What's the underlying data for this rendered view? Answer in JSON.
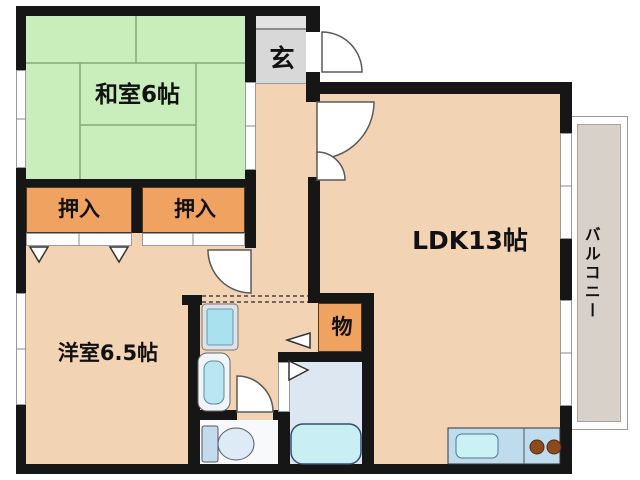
{
  "rooms": {
    "washitsu": {
      "label": "和室6帖"
    },
    "genkan": {
      "label": "玄"
    },
    "ldk": {
      "label": "LDK13帖"
    },
    "closet_left": {
      "label": "押入"
    },
    "closet_right": {
      "label": "押入"
    },
    "youshitsu": {
      "label": "洋室6.5帖"
    },
    "storage": {
      "label": "物"
    },
    "balcony": {
      "label": "バルコニー"
    }
  },
  "fixtures": {
    "washing_machine": "washing-machine-pan",
    "washbasin": "washbasin",
    "toilet": "toilet",
    "bathtub": "bathtub",
    "kitchen_sink": "kitchen-sink",
    "stove": "two-burner-stove"
  },
  "palette": {
    "wall": "#161616",
    "room_peach": "#f2d4b5",
    "tatami_green": "#c9eebb",
    "tatami_line": "#86aa74",
    "closet_orange": "#f0a360",
    "genkan_gray": "#d8d8d8",
    "balcony_gray": "#d7d1c9",
    "bath_floor": "#dde7f2",
    "water_blue": "#a9e2ee",
    "tub_blue": "#c9eef3",
    "counter_blue": "#bedced",
    "burner_brown": "#8c4a1e"
  }
}
